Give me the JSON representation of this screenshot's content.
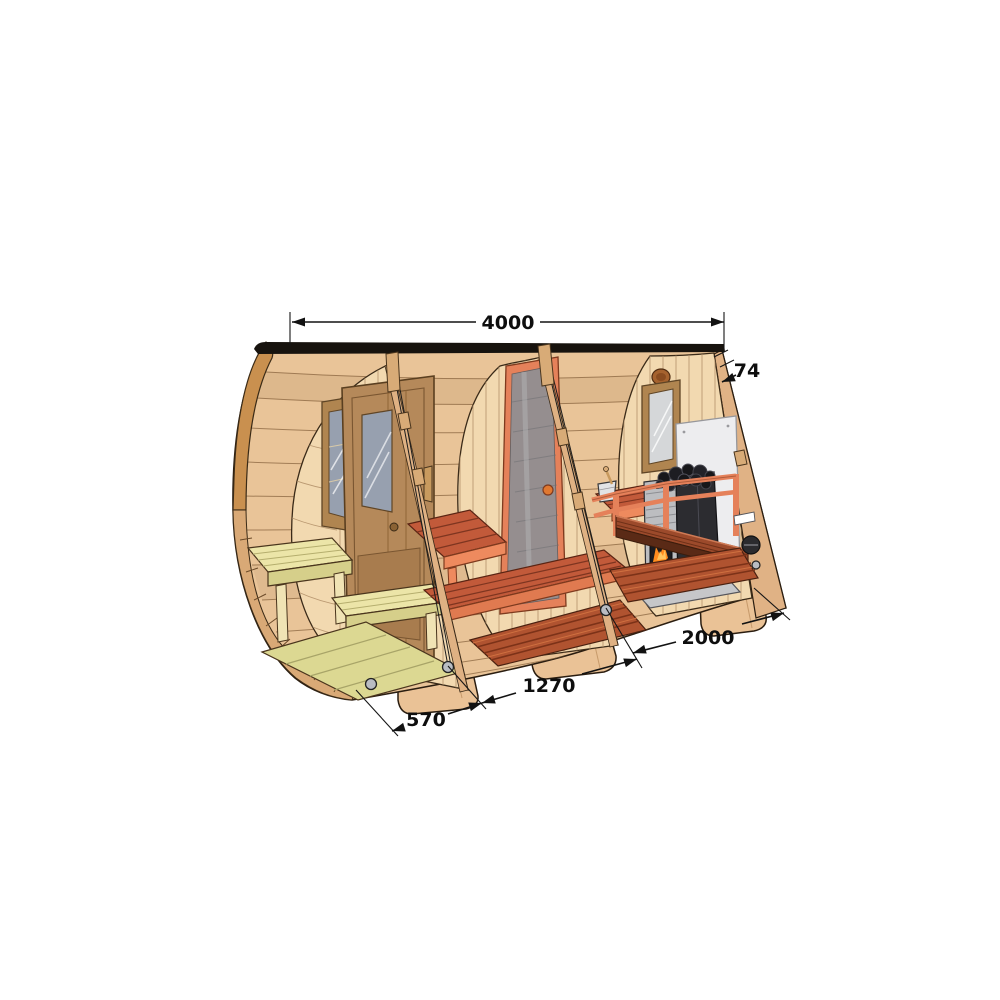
{
  "diagram": {
    "type": "technical-cutaway-illustration",
    "subject": "barrel-sauna-with-porch-interior-cutaway",
    "dimensions": {
      "overall_length": "4000",
      "wall_thickness": "74",
      "sauna_room_length": "2000",
      "middle_room_length": "1270",
      "porch_length": "570"
    },
    "colors": {
      "background": "#ffffff",
      "wood_exterior": "#e9c498",
      "wood_trim": "#c9904f",
      "interior_wall": "#f2d9b0",
      "accent_orange": "#e5815a",
      "bench_red": "#c25a3a",
      "floor_red": "#b05330",
      "porch_wood_pale": "#e7e3a3",
      "heater_black": "#2c2c30",
      "heater_grey": "#bcbdc0",
      "heat_shield": "#ededef",
      "glass_grey": "#8f9094",
      "dimension_line": "#121212"
    }
  }
}
